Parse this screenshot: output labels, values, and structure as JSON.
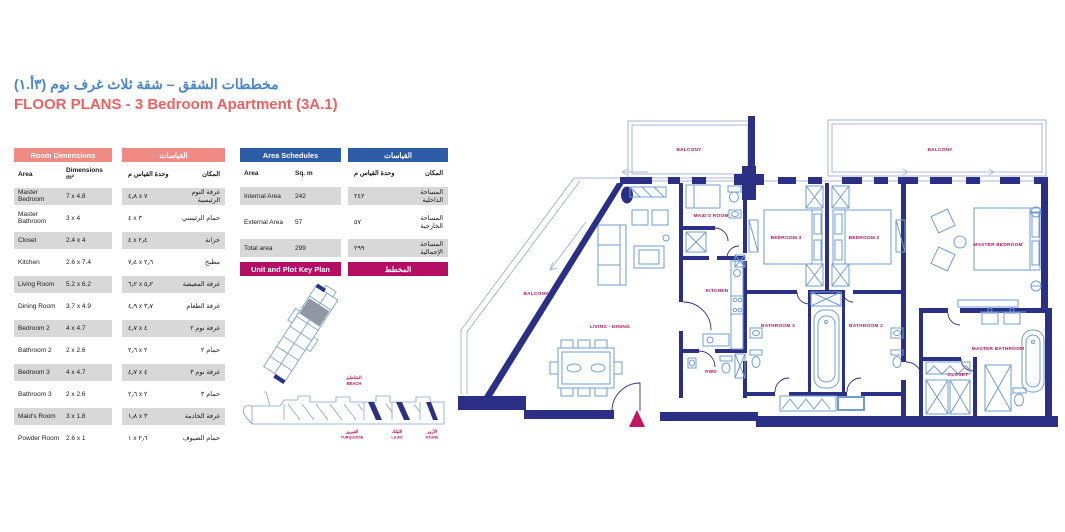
{
  "page": {
    "title_ar": "مخططات الشقق – شقة ثلاث غرف نوم (٣أ.١)",
    "title_en": "FLOOR PLANS - 3 Bedroom Apartment (3A.1)"
  },
  "colors": {
    "accent_blue": "#4a86c8",
    "accent_red": "#ef5f62",
    "room_table_header": "#f08a84",
    "area_table_header": "#2e5ba6",
    "key_plan_header": "#b50d63",
    "wall_navy": "#2b3086",
    "furniture_blue": "#6f9cd6",
    "plan_label_pink": "#c3115f",
    "row_gray": "#d8d8d8"
  },
  "room_dimensions": {
    "title_en": "Room Dimensions",
    "title_ar": "القياسات",
    "col_area_en": "Area",
    "col_dim_en": "Dimensions m²",
    "col_dim_ar": "وحدة القياس م",
    "col_area_ar": "المكان",
    "rows": [
      {
        "area_en": "Master Bedroom",
        "dim_en": "7 x 4.8",
        "dim_ar": "٤٫٨ x ٧",
        "area_ar": "غرفة النوم الرئيسية"
      },
      {
        "area_en": "Master Bathroom",
        "dim_en": "3 x 4",
        "dim_ar": "٤ x ٣",
        "area_ar": "حمام الرئيسي"
      },
      {
        "area_en": "Closet",
        "dim_en": "2.4 x 4",
        "dim_ar": "٤ x ٢٫٤",
        "area_ar": "خزانة"
      },
      {
        "area_en": "Kitchen",
        "dim_en": "2.6 x 7.4",
        "dim_ar": "٧٫٤ x ٢٫٦",
        "area_ar": "مطبخ"
      },
      {
        "area_en": "Living Room",
        "dim_en": "5.2 x 6.2",
        "dim_ar": "٦٫٢ x ٥٫٢",
        "area_ar": "غرفة المعيشة"
      },
      {
        "area_en": "Dining Room",
        "dim_en": "3.7 x 4.9",
        "dim_ar": "٤٫٩ x ٣٫٧",
        "area_ar": "غرفة الطعام"
      },
      {
        "area_en": "Bedroom 2",
        "dim_en": "4 x 4.7",
        "dim_ar": "٤٫٧ x ٤",
        "area_ar": "غرفة نوم ٢"
      },
      {
        "area_en": "Bathroom 2",
        "dim_en": "2 x 2.6",
        "dim_ar": "٢٫٦ x ٢",
        "area_ar": "حمام ٢"
      },
      {
        "area_en": "Bedroom 3",
        "dim_en": "4 x 4.7",
        "dim_ar": "٤٫٧ x ٤",
        "area_ar": "غرفة نوم ٣"
      },
      {
        "area_en": "Bathroom 3",
        "dim_en": "2 x 2.6",
        "dim_ar": "٢٫٦ x ٢",
        "area_ar": "حمام ٣"
      },
      {
        "area_en": "Maid's Room",
        "dim_en": "3 x 1.8",
        "dim_ar": "١٫٨ x ٣",
        "area_ar": "غرفة الخادمة"
      },
      {
        "area_en": "Powder Room",
        "dim_en": "2.6 x 1",
        "dim_ar": "١ x ٢٫٦",
        "area_ar": "حمام الضيوف"
      }
    ]
  },
  "area_schedules": {
    "title_en": "Area Schedules",
    "title_ar": "القياسات",
    "col_area_en": "Area",
    "col_sqm_en": "Sq. m",
    "col_sqm_ar": "وحدة القياس م",
    "col_area_ar": "المكان",
    "rows": [
      {
        "en": "Internal Area",
        "sqm": "242",
        "sqm_ar": "٢٤٢",
        "ar": "المساحة الداخلية"
      },
      {
        "en": "External Area",
        "sqm": "57",
        "sqm_ar": "٥٧",
        "ar": "المساحة الخارجية"
      },
      {
        "en": "Total area",
        "sqm": "299",
        "sqm_ar": "٢٩٩",
        "ar": "المساحة الإجمالية"
      }
    ]
  },
  "key_plan": {
    "title_en": "Unit and Plot Key Plan",
    "title_ar": "المخطط",
    "beach_ar": "الشاطئ",
    "beach_en": "BEACH",
    "towers": [
      {
        "ar": "الفيروز",
        "en": "TURQUOISE"
      },
      {
        "ar": "الليلك",
        "en": "LILAC"
      },
      {
        "ar": "الأزور",
        "en": "AZURE"
      }
    ]
  },
  "floor_plan": {
    "labels": {
      "balcony_top": "BALCONY",
      "balcony_right": "BALCONY",
      "balcony_side": "BALCONY",
      "maids_room": "MAID'S ROOM",
      "kitchen": "KITCHEN",
      "living_dining": "LIVING - DINING",
      "pwd": "PWD",
      "bedroom3": "BEDROOM 3",
      "bedroom2": "BEDROOM 2",
      "master_bedroom": "MASTER BEDROOM",
      "bathroom3": "BATHROOM 3",
      "bathroom2": "BATHROOM 2",
      "master_bathroom": "MASTER BATHROOM",
      "closet": "CLOSET"
    }
  }
}
